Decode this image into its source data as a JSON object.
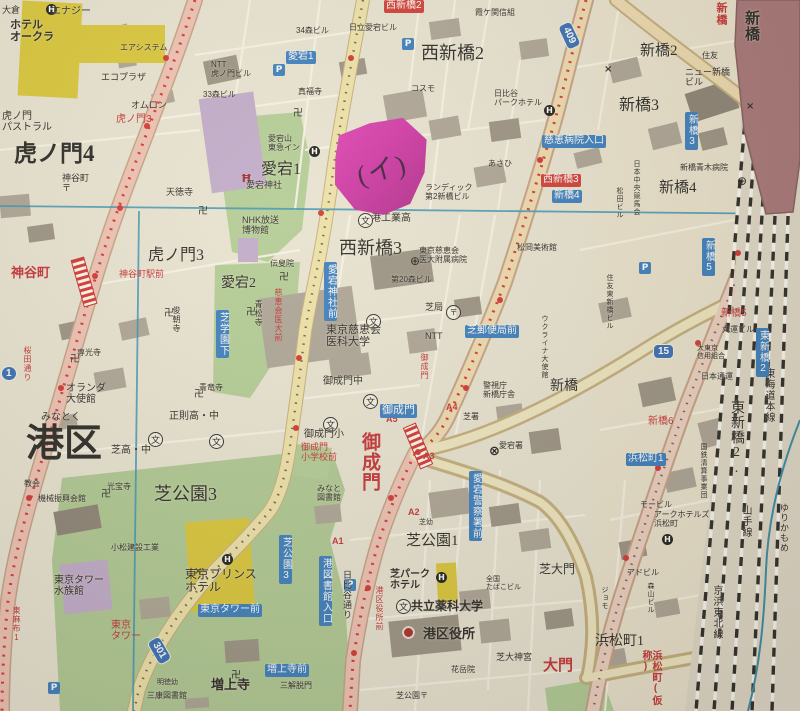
{
  "note": {
    "text": "(イ)",
    "color": "#cc2ba4"
  },
  "palette": {
    "paper": "#e8e3d4",
    "road_pink": "#eec0b4",
    "road_yellow": "#eee2a8",
    "green": "#afc996",
    "building_gray": "#a8a094",
    "public_purple": "#bda7cc",
    "hotel_yellow": "#d8c531",
    "station_red": "#a26f74",
    "sign_blue": "#2e77bf",
    "sign_red": "#cd3330",
    "index_line": "#2f8fb5",
    "subway_dash": "#d22a2a"
  },
  "route_shields": [
    {
      "n": "1",
      "x": 1,
      "y": 366,
      "rot": 0,
      "round": true
    },
    {
      "n": "409",
      "x": 556,
      "y": 28,
      "rot": 65,
      "round": false
    },
    {
      "n": "15",
      "x": 653,
      "y": 344,
      "rot": 0,
      "round": false
    },
    {
      "n": "301",
      "x": 146,
      "y": 643,
      "rot": 60,
      "round": false
    }
  ],
  "labels": [
    {
      "t": "虎ノ門4",
      "x": 14,
      "y": 142,
      "fs": 23,
      "c": "k",
      "ser": true,
      "b": true
    },
    {
      "t": "虎ノ門3",
      "x": 148,
      "y": 247,
      "fs": 16,
      "c": "k",
      "ser": true
    },
    {
      "t": "愛宕1",
      "x": 261,
      "y": 161,
      "fs": 16,
      "c": "k",
      "ser": true
    },
    {
      "t": "愛宕2",
      "x": 221,
      "y": 276,
      "fs": 14,
      "c": "k",
      "ser": true
    },
    {
      "t": "西新橋2",
      "x": 421,
      "y": 44,
      "fs": 18,
      "c": "k",
      "ser": true
    },
    {
      "t": "西新橋3",
      "x": 339,
      "y": 239,
      "fs": 18,
      "c": "k",
      "ser": true
    },
    {
      "t": "みなとく",
      "x": 41,
      "y": 413,
      "fs": 10,
      "c": "k"
    },
    {
      "t": "港区",
      "x": 26,
      "y": 424,
      "fs": 38,
      "c": "k",
      "ser": true,
      "b": true
    },
    {
      "t": "新橋2",
      "x": 640,
      "y": 43,
      "fs": 15,
      "c": "k",
      "ser": true
    },
    {
      "t": "新橋3",
      "x": 619,
      "y": 97,
      "fs": 16,
      "c": "k",
      "ser": true
    },
    {
      "t": "新橋4",
      "x": 659,
      "y": 180,
      "fs": 15,
      "c": "k",
      "ser": true
    },
    {
      "t": "新橋",
      "x": 550,
      "y": 379,
      "fs": 14,
      "c": "k",
      "ser": true
    },
    {
      "t": "芝公園3",
      "x": 154,
      "y": 485,
      "fs": 18,
      "c": "k",
      "ser": true
    },
    {
      "t": "芝公園1",
      "x": 406,
      "y": 533,
      "fs": 15,
      "c": "k",
      "ser": true
    },
    {
      "t": "浜松町1",
      "x": 595,
      "y": 634,
      "fs": 14,
      "c": "k",
      "ser": true
    },
    {
      "t": "芝大門",
      "x": 539,
      "y": 563,
      "fs": 12,
      "c": "k",
      "ser": true
    },
    {
      "t": "東新橋2.",
      "x": 729,
      "y": 400,
      "fs": 14,
      "c": "k",
      "ser": true,
      "v": true
    },
    {
      "t": "増上寺",
      "x": 211,
      "y": 678,
      "fs": 13,
      "c": "k",
      "ser": true,
      "b": true
    },
    {
      "t": "東海道本線",
      "x": 763,
      "y": 368,
      "fs": 10,
      "c": "k",
      "v": true
    },
    {
      "t": "山手線",
      "x": 740,
      "y": 505,
      "fs": 10,
      "c": "k",
      "v": true
    },
    {
      "t": "京浜東北線",
      "x": 711,
      "y": 585,
      "fs": 10,
      "c": "k",
      "v": true
    },
    {
      "t": "ゆりかもめ",
      "x": 779,
      "y": 503,
      "fs": 9,
      "c": "k",
      "v": true
    },
    {
      "t": "新橋",
      "x": 744,
      "y": 10,
      "fs": 15,
      "c": "k",
      "v": true,
      "b": true
    },
    {
      "t": "虎ノ門3",
      "x": 116,
      "y": 115,
      "fs": 10,
      "c": "r"
    },
    {
      "t": "神谷町",
      "x": 11,
      "y": 266,
      "fs": 13,
      "c": "r",
      "b": true
    },
    {
      "t": "神谷町駅前",
      "x": 119,
      "y": 270,
      "fs": 9,
      "c": "r"
    },
    {
      "t": "桜田通り",
      "x": 23,
      "y": 346,
      "fs": 8,
      "c": "r",
      "v": true
    },
    {
      "t": "慈恵会医大前",
      "x": 274,
      "y": 288,
      "fs": 8,
      "c": "r",
      "v": true
    },
    {
      "t": "御成門",
      "x": 420,
      "y": 353,
      "fs": 8,
      "c": "r",
      "v": true
    },
    {
      "t": "御成門\n小学校前",
      "x": 301,
      "y": 443,
      "fs": 9,
      "c": "r"
    },
    {
      "t": "御成門",
      "x": 360,
      "y": 432,
      "fs": 19,
      "c": "r",
      "v": true,
      "b": true
    },
    {
      "t": "A5",
      "x": 386,
      "y": 415,
      "fs": 9,
      "c": "r",
      "b": true
    },
    {
      "t": "A4",
      "x": 446,
      "y": 403,
      "fs": 9,
      "c": "r",
      "b": true
    },
    {
      "t": "A3",
      "x": 423,
      "y": 452,
      "fs": 9,
      "c": "r",
      "b": true
    },
    {
      "t": "A2",
      "x": 408,
      "y": 508,
      "fs": 9,
      "c": "r",
      "b": true
    },
    {
      "t": "A1",
      "x": 332,
      "y": 537,
      "fs": 9,
      "c": "r",
      "b": true
    },
    {
      "t": "新橋5",
      "x": 721,
      "y": 309,
      "fs": 10,
      "c": "r"
    },
    {
      "t": "新橋6",
      "x": 648,
      "y": 417,
      "fs": 10,
      "c": "r"
    },
    {
      "t": "東京\nタワー",
      "x": 111,
      "y": 621,
      "fs": 10,
      "c": "r"
    },
    {
      "t": "大門",
      "x": 543,
      "y": 658,
      "fs": 15,
      "c": "r",
      "b": true
    },
    {
      "t": "浜松町(仮称)",
      "x": 640,
      "y": 650,
      "fs": 10,
      "c": "r",
      "v": true,
      "b": true
    },
    {
      "t": "新橋",
      "x": 715,
      "y": 2,
      "fs": 11,
      "c": "r",
      "v": true,
      "b": true
    },
    {
      "t": "東麻布1",
      "x": 12,
      "y": 606,
      "fs": 8,
      "c": "r",
      "v": true
    },
    {
      "t": "港区役所前",
      "x": 375,
      "y": 586,
      "fs": 8,
      "c": "r",
      "v": true
    },
    {
      "t": "西新橋2",
      "x": 384,
      "y": 0,
      "fs": 10,
      "c": "wr"
    },
    {
      "t": "西新橋3",
      "x": 541,
      "y": 174,
      "fs": 10,
      "c": "wr"
    },
    {
      "t": "愛宕1",
      "x": 286,
      "y": 51,
      "fs": 10,
      "c": "w"
    },
    {
      "t": "慈恵病院入口",
      "x": 542,
      "y": 135,
      "fs": 10,
      "c": "w"
    },
    {
      "t": "新橋4",
      "x": 552,
      "y": 190,
      "fs": 10,
      "c": "w"
    },
    {
      "t": "新橋3",
      "x": 685,
      "y": 112,
      "fs": 10,
      "c": "w",
      "v": true
    },
    {
      "t": "新橋5",
      "x": 702,
      "y": 238,
      "fs": 10,
      "c": "w",
      "v": true
    },
    {
      "t": "東新橋2",
      "x": 756,
      "y": 328,
      "fs": 10,
      "c": "w",
      "v": true
    },
    {
      "t": "芝学園下",
      "x": 216,
      "y": 310,
      "fs": 10,
      "c": "w",
      "v": true
    },
    {
      "t": "愛宕神社前",
      "x": 324,
      "y": 262,
      "fs": 10,
      "c": "w",
      "v": true
    },
    {
      "t": "御成門",
      "x": 380,
      "y": 404,
      "fs": 11,
      "c": "w"
    },
    {
      "t": "芝郵便局前",
      "x": 465,
      "y": 325,
      "fs": 10,
      "c": "w"
    },
    {
      "t": "愛宕警察署前",
      "x": 469,
      "y": 471,
      "fs": 10,
      "c": "w",
      "v": true
    },
    {
      "t": "芝公園3",
      "x": 279,
      "y": 535,
      "fs": 10,
      "c": "w",
      "v": true
    },
    {
      "t": "港図書館入口",
      "x": 319,
      "y": 556,
      "fs": 10,
      "c": "w",
      "v": true
    },
    {
      "t": "東京タワー前",
      "x": 198,
      "y": 604,
      "fs": 10,
      "c": "w"
    },
    {
      "t": "増上寺前",
      "x": 265,
      "y": 664,
      "fs": 10,
      "c": "w"
    },
    {
      "t": "浜松町1",
      "x": 626,
      "y": 453,
      "fs": 10,
      "c": "w"
    },
    {
      "t": "エナジー",
      "x": 51,
      "y": 7,
      "fs": 10,
      "c": "k"
    },
    {
      "t": "大倉",
      "x": 2,
      "y": 6,
      "fs": 9,
      "c": "k"
    },
    {
      "t": "ホテル\nオークラ",
      "x": 10,
      "y": 20,
      "fs": 11,
      "c": "k",
      "b": true
    },
    {
      "t": "エアシステム",
      "x": 120,
      "y": 44,
      "fs": 8,
      "c": "k"
    },
    {
      "t": "エコプラザ",
      "x": 101,
      "y": 73,
      "fs": 9,
      "c": "k"
    },
    {
      "t": "オムロン",
      "x": 131,
      "y": 101,
      "fs": 9,
      "c": "k"
    },
    {
      "t": "NTT\n虎ノ門ビル",
      "x": 211,
      "y": 61,
      "fs": 8,
      "c": "k"
    },
    {
      "t": "33森ビル",
      "x": 203,
      "y": 91,
      "fs": 8,
      "c": "k"
    },
    {
      "t": "34森ビル",
      "x": 296,
      "y": 27,
      "fs": 8,
      "c": "k"
    },
    {
      "t": "虎ノ門\nパストラル",
      "x": 2,
      "y": 112,
      "fs": 10,
      "c": "k"
    },
    {
      "t": "神谷町\n〒",
      "x": 62,
      "y": 174,
      "fs": 9,
      "c": "k"
    },
    {
      "t": "天徳寺",
      "x": 166,
      "y": 188,
      "fs": 9,
      "c": "k"
    },
    {
      "t": "真福寺",
      "x": 298,
      "y": 88,
      "fs": 8,
      "c": "k"
    },
    {
      "t": "愛宕山\n東急イン",
      "x": 268,
      "y": 135,
      "fs": 8,
      "c": "k"
    },
    {
      "t": "愛宕神社",
      "x": 246,
      "y": 181,
      "fs": 9,
      "c": "k"
    },
    {
      "t": "NHK放送\n博物館",
      "x": 242,
      "y": 216,
      "fs": 9,
      "c": "k"
    },
    {
      "t": "青松寺",
      "x": 254,
      "y": 300,
      "fs": 8,
      "c": "k",
      "v": true
    },
    {
      "t": "俊朝寺",
      "x": 172,
      "y": 306,
      "fs": 8,
      "c": "k",
      "v": true
    },
    {
      "t": "伝叟院",
      "x": 270,
      "y": 260,
      "fs": 8,
      "c": "k"
    },
    {
      "t": "専光寺",
      "x": 77,
      "y": 349,
      "fs": 8,
      "c": "k"
    },
    {
      "t": "青竜寺",
      "x": 199,
      "y": 384,
      "fs": 8,
      "c": "k"
    },
    {
      "t": "オランダ\n大使館",
      "x": 66,
      "y": 384,
      "fs": 10,
      "c": "k"
    },
    {
      "t": "正則高・中",
      "x": 169,
      "y": 412,
      "fs": 10,
      "c": "k"
    },
    {
      "t": "芝高・中",
      "x": 111,
      "y": 446,
      "fs": 10,
      "c": "k"
    },
    {
      "t": "港工業高",
      "x": 371,
      "y": 214,
      "fs": 10,
      "c": "k"
    },
    {
      "t": "東京慈恵会\n医科大学",
      "x": 326,
      "y": 325,
      "fs": 11,
      "c": "k"
    },
    {
      "t": "東京慈恵会\n医大附属病院",
      "x": 419,
      "y": 247,
      "fs": 8,
      "c": "k"
    },
    {
      "t": "第20森ビル",
      "x": 391,
      "y": 276,
      "fs": 8,
      "c": "k"
    },
    {
      "t": "芝局",
      "x": 425,
      "y": 303,
      "fs": 9,
      "c": "k"
    },
    {
      "t": "NTT",
      "x": 425,
      "y": 332,
      "fs": 9,
      "c": "k"
    },
    {
      "t": "御成門中",
      "x": 323,
      "y": 377,
      "fs": 10,
      "c": "k"
    },
    {
      "t": "御成門小",
      "x": 304,
      "y": 430,
      "fs": 10,
      "c": "k"
    },
    {
      "t": "警視庁\n新橋庁舎",
      "x": 483,
      "y": 382,
      "fs": 8,
      "c": "k"
    },
    {
      "t": "愛宕署",
      "x": 499,
      "y": 442,
      "fs": 8,
      "c": "k"
    },
    {
      "t": "芝署",
      "x": 463,
      "y": 413,
      "fs": 8,
      "c": "k"
    },
    {
      "t": "霞ケ関信組",
      "x": 475,
      "y": 9,
      "fs": 8,
      "c": "k"
    },
    {
      "t": "日立愛宕ビル",
      "x": 349,
      "y": 24,
      "fs": 8,
      "c": "k"
    },
    {
      "t": "コスモ",
      "x": 411,
      "y": 85,
      "fs": 8,
      "c": "k"
    },
    {
      "t": "日比谷\nパークホテル",
      "x": 494,
      "y": 90,
      "fs": 8,
      "c": "k"
    },
    {
      "t": "あさひ",
      "x": 488,
      "y": 160,
      "fs": 8,
      "c": "k"
    },
    {
      "t": "ランディック\n第2新橋ビル",
      "x": 425,
      "y": 184,
      "fs": 8,
      "c": "k"
    },
    {
      "t": "ニュー新橋\nビル",
      "x": 685,
      "y": 68,
      "fs": 9,
      "c": "k"
    },
    {
      "t": "新橋青木病院",
      "x": 680,
      "y": 164,
      "fs": 8,
      "c": "k"
    },
    {
      "t": "住友",
      "x": 702,
      "y": 52,
      "fs": 8,
      "c": "k"
    },
    {
      "t": "松岡美術館",
      "x": 517,
      "y": 244,
      "fs": 8,
      "c": "k"
    },
    {
      "t": "日本中央競馬会",
      "x": 633,
      "y": 160,
      "fs": 7,
      "c": "k",
      "v": true
    },
    {
      "t": "松田ビル",
      "x": 616,
      "y": 187,
      "fs": 7,
      "c": "k",
      "v": true
    },
    {
      "t": "ウクライナ大使館",
      "x": 541,
      "y": 315,
      "fs": 7,
      "c": "k",
      "v": true
    },
    {
      "t": "丸運ビル",
      "x": 722,
      "y": 326,
      "fs": 8,
      "c": "k"
    },
    {
      "t": "大東京\n信用組合",
      "x": 697,
      "y": 345,
      "fs": 7,
      "c": "k"
    },
    {
      "t": "日本通運",
      "x": 701,
      "y": 373,
      "fs": 8,
      "c": "k"
    },
    {
      "t": "国鉄清算事業団",
      "x": 700,
      "y": 443,
      "fs": 7,
      "c": "k",
      "v": true
    },
    {
      "t": "住友東新橋ビル",
      "x": 606,
      "y": 274,
      "fs": 7,
      "c": "k",
      "v": true
    },
    {
      "t": "モービル",
      "x": 640,
      "y": 501,
      "fs": 8,
      "c": "k"
    },
    {
      "t": "アークホテルズ\n浜松町",
      "x": 654,
      "y": 511,
      "fs": 8,
      "c": "k"
    },
    {
      "t": "アドビル",
      "x": 627,
      "y": 569,
      "fs": 8,
      "c": "k"
    },
    {
      "t": "森山ビル",
      "x": 647,
      "y": 582,
      "fs": 7,
      "c": "k",
      "v": true
    },
    {
      "t": "ジョモ",
      "x": 601,
      "y": 586,
      "fs": 7,
      "c": "k",
      "v": true
    },
    {
      "t": "機械振興会館",
      "x": 38,
      "y": 495,
      "fs": 8,
      "c": "k"
    },
    {
      "t": "教会",
      "x": 24,
      "y": 480,
      "fs": 8,
      "c": "k"
    },
    {
      "t": "光宝寺",
      "x": 107,
      "y": 483,
      "fs": 8,
      "c": "k"
    },
    {
      "t": "小松建設工業",
      "x": 111,
      "y": 544,
      "fs": 8,
      "c": "k"
    },
    {
      "t": "東京タワー\n水族館",
      "x": 54,
      "y": 576,
      "fs": 10,
      "c": "k"
    },
    {
      "t": "東京プリンス\nホテル",
      "x": 185,
      "y": 568,
      "fs": 12,
      "c": "k"
    },
    {
      "t": "みなと\n図書館",
      "x": 317,
      "y": 485,
      "fs": 8,
      "c": "k"
    },
    {
      "t": "日比谷通り",
      "x": 342,
      "y": 570,
      "fs": 9,
      "c": "k",
      "v": true
    },
    {
      "t": "芝パーク\nホテル",
      "x": 390,
      "y": 570,
      "fs": 10,
      "c": "k",
      "b": true
    },
    {
      "t": "共立薬科大学",
      "x": 411,
      "y": 600,
      "fs": 12,
      "c": "k",
      "b": true
    },
    {
      "t": "港区役所",
      "x": 423,
      "y": 627,
      "fs": 13,
      "c": "k",
      "b": true
    },
    {
      "t": "花岳院",
      "x": 451,
      "y": 666,
      "fs": 8,
      "c": "k"
    },
    {
      "t": "芝大神宮",
      "x": 496,
      "y": 653,
      "fs": 9,
      "c": "k"
    },
    {
      "t": "全国\nたばこビル",
      "x": 486,
      "y": 576,
      "fs": 7,
      "c": "k"
    },
    {
      "t": "芝幼",
      "x": 419,
      "y": 519,
      "fs": 7,
      "c": "k"
    },
    {
      "t": "明徳幼",
      "x": 157,
      "y": 679,
      "fs": 7,
      "c": "k"
    },
    {
      "t": "三康図書館",
      "x": 147,
      "y": 692,
      "fs": 8,
      "c": "k"
    },
    {
      "t": "三解脱門",
      "x": 280,
      "y": 682,
      "fs": 8,
      "c": "k"
    },
    {
      "t": "芝公園〒",
      "x": 396,
      "y": 692,
      "fs": 8,
      "c": "k"
    }
  ],
  "icons": [
    {
      "k": "school",
      "x": 358,
      "y": 213
    },
    {
      "k": "school",
      "x": 366,
      "y": 314
    },
    {
      "k": "school",
      "x": 363,
      "y": 394
    },
    {
      "k": "school",
      "x": 323,
      "y": 417
    },
    {
      "k": "school",
      "x": 209,
      "y": 434
    },
    {
      "k": "school",
      "x": 148,
      "y": 432
    },
    {
      "k": "school",
      "x": 396,
      "y": 599
    },
    {
      "k": "hospital",
      "x": 410,
      "y": 254
    },
    {
      "k": "hospital",
      "x": 737,
      "y": 174
    },
    {
      "k": "post",
      "x": 446,
      "y": 305
    },
    {
      "k": "hotel",
      "x": 46,
      "y": 4
    },
    {
      "k": "hotel",
      "x": 309,
      "y": 146
    },
    {
      "k": "hotel",
      "x": 222,
      "y": 554
    },
    {
      "k": "hotel",
      "x": 436,
      "y": 572
    },
    {
      "k": "hotel",
      "x": 662,
      "y": 534
    },
    {
      "k": "hotel",
      "x": 544,
      "y": 105
    },
    {
      "k": "police",
      "x": 489,
      "y": 444
    },
    {
      "k": "ward",
      "x": 402,
      "y": 626
    },
    {
      "k": "torii",
      "x": 241,
      "y": 172
    },
    {
      "k": "temple",
      "x": 293,
      "y": 104
    },
    {
      "k": "temple",
      "x": 198,
      "y": 202
    },
    {
      "k": "temple",
      "x": 246,
      "y": 303
    },
    {
      "k": "temple",
      "x": 164,
      "y": 304
    },
    {
      "k": "temple",
      "x": 70,
      "y": 350
    },
    {
      "k": "temple",
      "x": 194,
      "y": 385
    },
    {
      "k": "temple",
      "x": 231,
      "y": 666
    },
    {
      "k": "temple",
      "x": 101,
      "y": 485
    },
    {
      "k": "temple",
      "x": 279,
      "y": 268
    },
    {
      "k": "parking",
      "x": 402,
      "y": 38
    },
    {
      "k": "parking",
      "x": 273,
      "y": 64
    },
    {
      "k": "parking",
      "x": 639,
      "y": 262
    },
    {
      "k": "parking",
      "x": 344,
      "y": 579
    },
    {
      "k": "parking",
      "x": 48,
      "y": 682
    },
    {
      "k": "x",
      "x": 604,
      "y": 64
    },
    {
      "k": "x",
      "x": 746,
      "y": 101
    },
    {
      "k": "x",
      "x": 194,
      "y": 566
    }
  ]
}
